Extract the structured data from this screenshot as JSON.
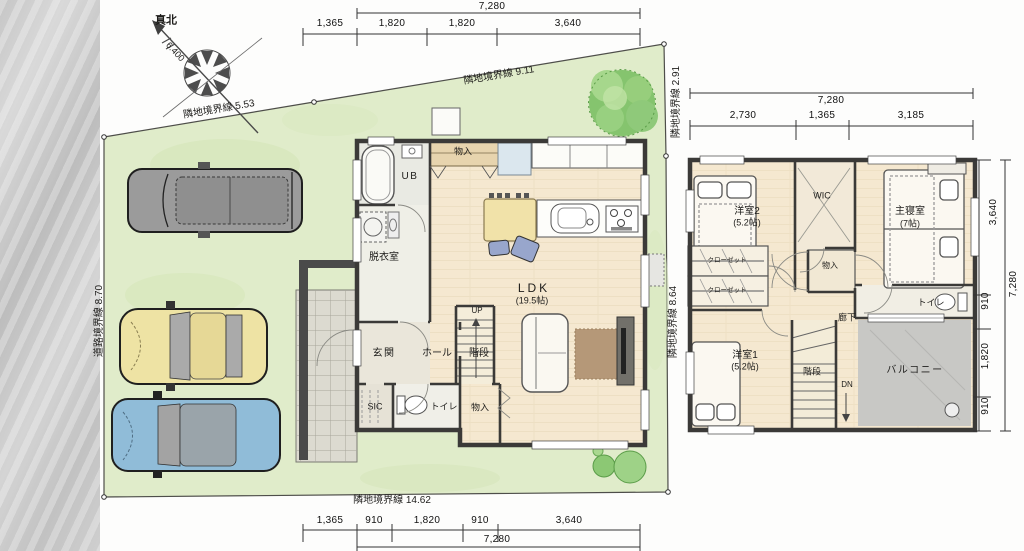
{
  "compass": {
    "north": "真北",
    "declination": "6.400"
  },
  "boundaries": {
    "top_left": "隣地境界線 5.53",
    "top_right": "隣地境界線 9.11",
    "right_upper": "隣地境界線 2.91",
    "right_lower": "隣地境界線 8.64",
    "bottom": "隣地境界線 14.62",
    "left": "道路境界線 8.70"
  },
  "floor1": {
    "dims_top": {
      "total": "7,280",
      "segments": [
        "1,365",
        "1,820",
        "1,820",
        "3,640"
      ]
    },
    "dims_bottom": {
      "segments": [
        "1,365",
        "910",
        "1,820",
        "910",
        "3,640"
      ],
      "total": "7,280"
    },
    "rooms": {
      "storage_top": "物入",
      "ub": "UB",
      "dressing": "脱衣室",
      "ldk": "LDK",
      "ldk_size": "(19.5帖)",
      "entrance": "玄関",
      "hall": "ホール",
      "stairs": "階段",
      "up": "UP",
      "sic": "SIC",
      "toilet": "トイレ",
      "storage_bottom": "物入"
    }
  },
  "floor2": {
    "dims_top": {
      "total": "7,280",
      "segments": [
        "2,730",
        "1,365",
        "3,185"
      ]
    },
    "dims_right": {
      "outer_total": "7,280",
      "upper": "3,640",
      "segments": [
        "910",
        "1,820",
        "910"
      ]
    },
    "rooms": {
      "bedroom2": "洋室2",
      "bedroom2_size": "(5.2帖)",
      "wic": "WIC",
      "master": "主寝室",
      "master_size": "(7帖)",
      "closet1": "クローゼット",
      "closet2": "クローゼット",
      "storage": "物入",
      "corridor": "廊下",
      "toilet": "トイレ",
      "bedroom1": "洋室1",
      "bedroom1_size": "(5.2帖)",
      "stairs": "階段",
      "dn": "DN",
      "balcony": "バルコニー"
    }
  },
  "colors": {
    "lawn": "#e0ecca",
    "floor_wood": "#f5e8d0",
    "balcony_gray": "#c8c8c5",
    "car_gray": "#9b9b9b",
    "car_yellow": "#eee3a4",
    "car_blue": "#90bcd8",
    "tree_green": "#85c46e"
  }
}
